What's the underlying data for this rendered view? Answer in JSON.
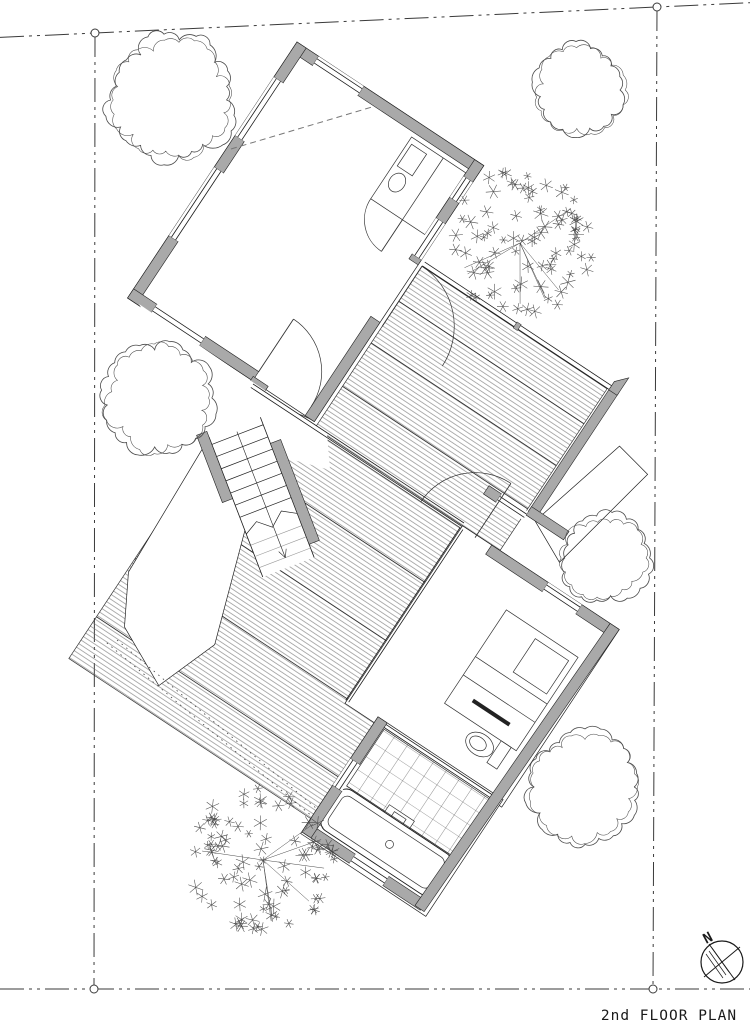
{
  "title": {
    "text": "2nd FLOOR PLAN"
  },
  "labels": {
    "stairs_down": "DN",
    "compass_north": "N"
  },
  "colors": {
    "paper": "#ffffff",
    "wall_fill": "#a9a9a9",
    "line": "#1a1a1a",
    "thin_line": "#333333",
    "hatch_line": "#6f6f6f",
    "tree_line": "#4a4a4a",
    "boundary_line": "#3a3a3a",
    "faint_line": "#999999"
  },
  "site": {
    "boundary_corners": [
      [
        95,
        33
      ],
      [
        657,
        7
      ],
      [
        653,
        989
      ],
      [
        94,
        989
      ]
    ],
    "corner_marker_radius": 4
  },
  "trees": [
    {
      "kind": "broadleaf",
      "cx": 172,
      "cy": 100,
      "r": 62
    },
    {
      "kind": "broadleaf",
      "cx": 580,
      "cy": 90,
      "r": 45
    },
    {
      "kind": "conifer",
      "cx": 520,
      "cy": 243,
      "r": 76
    },
    {
      "kind": "broadleaf",
      "cx": 158,
      "cy": 398,
      "r": 55
    },
    {
      "kind": "broadleaf",
      "cx": 604,
      "cy": 558,
      "r": 44
    },
    {
      "kind": "broadleaf",
      "cx": 585,
      "cy": 787,
      "r": 56
    },
    {
      "kind": "conifer",
      "cx": 263,
      "cy": 860,
      "r": 77
    }
  ]
}
